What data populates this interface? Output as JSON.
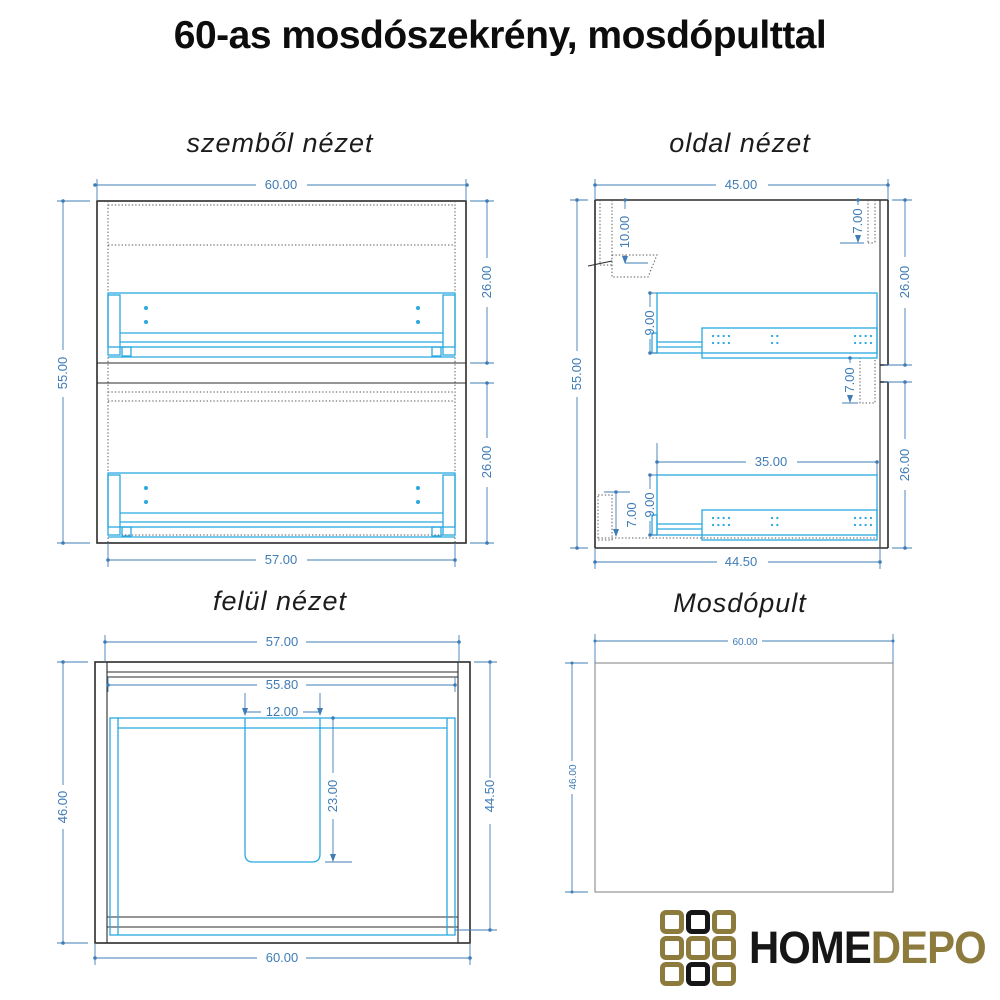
{
  "title": "60-as mosdószekrény, mosdópulttal",
  "views": {
    "front": {
      "title": "szemből nézet",
      "dims": {
        "overall_width": "60.00",
        "overall_height": "55.00",
        "upper_drawer_height": "26.00",
        "lower_drawer_height": "26.00",
        "inner_width": "57.00"
      }
    },
    "side": {
      "title": "oldal nézet",
      "dims": {
        "overall_depth": "45.00",
        "overall_height": "55.00",
        "hanger_offset": "10.00",
        "top_rail_depth": "7.00",
        "upper_front_height": "26.00",
        "mid_rail_height": "7.00",
        "slide_length": "35.00",
        "upper_slide_height": "9.00",
        "lower_slide_height": "9.00",
        "bottom_rail_height": "7.00",
        "lower_front_height": "26.00",
        "bottom_depth": "44.50"
      }
    },
    "top": {
      "title": "felül nézet",
      "dims": {
        "outer_width": "57.00",
        "inner_width": "55.80",
        "cutout_width": "12.00",
        "cutout_depth": "23.00",
        "overall_depth": "46.00",
        "inner_depth": "44.50",
        "bottom_width": "60.00"
      }
    },
    "counter": {
      "title": "Mosdópult",
      "dims": {
        "width": "60.00",
        "depth": "46.00"
      }
    }
  },
  "logo": {
    "text_primary": "HOME",
    "text_secondary": "DEPO",
    "grid": [
      [
        "gold",
        "black",
        "gold"
      ],
      [
        "gold",
        "gold",
        "gold"
      ],
      [
        "gold",
        "black",
        "gold"
      ]
    ]
  },
  "colors": {
    "outline": "#2b2b2b",
    "hidden_line": "#5a5a5a",
    "hardware": "#29a9e0",
    "dimension": "#3f7cb6",
    "logo_gold": "#8d7b3e",
    "logo_black": "#161616"
  }
}
